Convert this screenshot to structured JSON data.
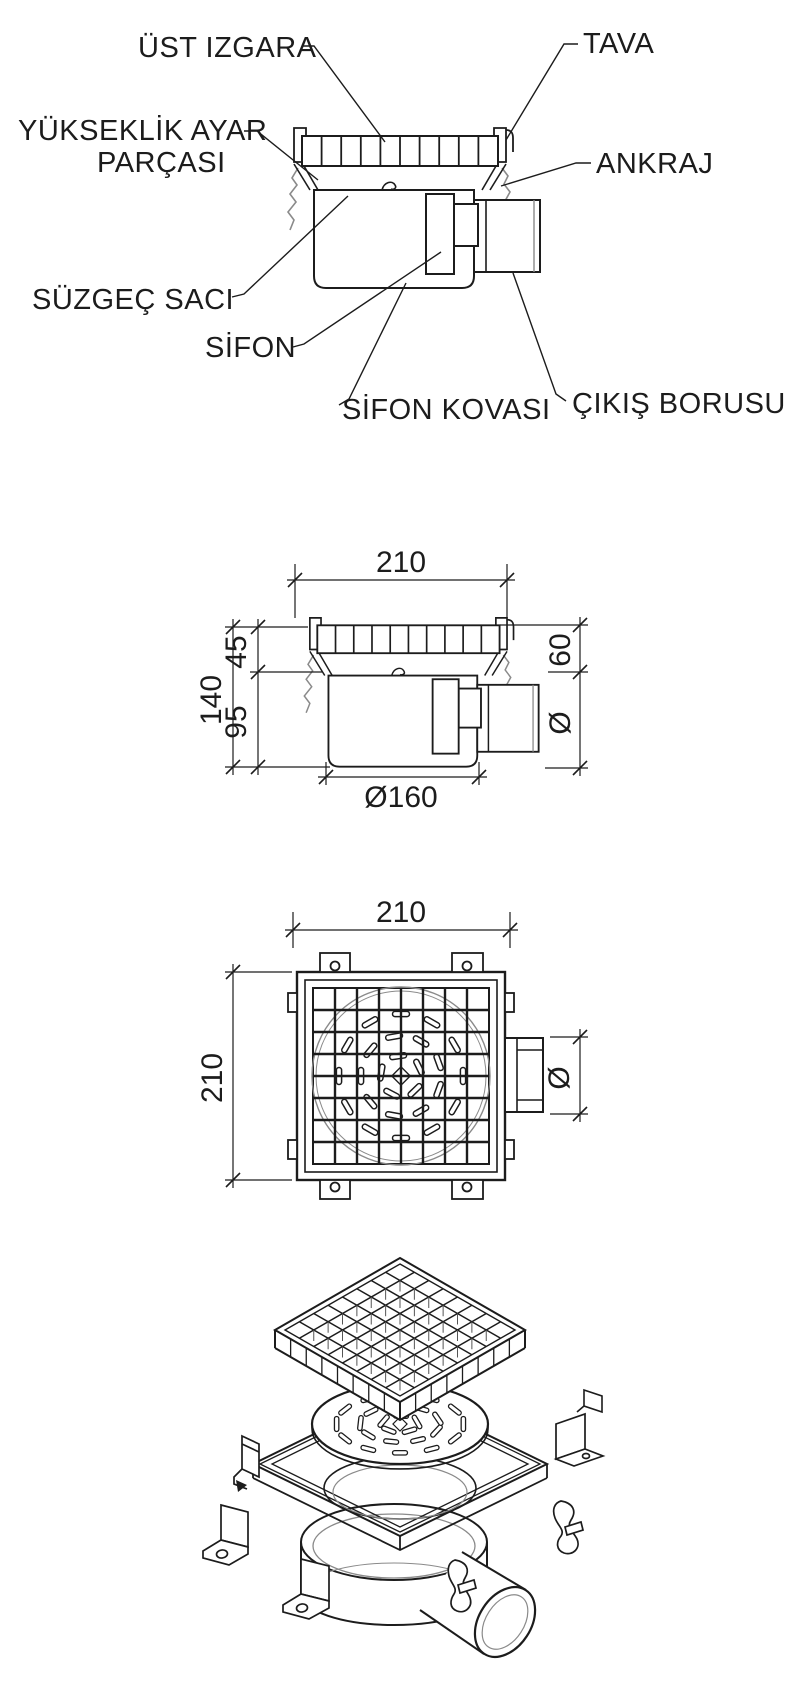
{
  "colors": {
    "background": "#ffffff",
    "line": "#1c1c1c",
    "thin_line": "#8a8a8a"
  },
  "part_labels": {
    "ust_izgara": "ÜST IZGARA",
    "tava": "TAVA",
    "yukseklik_ayar_line1": "YÜKSEKLİK AYAR",
    "yukseklik_ayar_line2": "PARÇASI",
    "ankraj": "ANKRAJ",
    "suzgec_saci": "SÜZGEÇ SACI",
    "sifon": "SİFON",
    "sifon_kovasi": "SİFON KOVASI",
    "cikis_borusu": "ÇIKIŞ BORUSU"
  },
  "side_view_dims": {
    "top_width": "210",
    "upper_height": "45",
    "lower_height": "95",
    "total_height": "140",
    "body_diameter": "Ø160",
    "outlet_offset": "60",
    "outlet_diameter": "Ø"
  },
  "plan_view_dims": {
    "width": "210",
    "height": "210",
    "outlet_diameter": "Ø"
  }
}
